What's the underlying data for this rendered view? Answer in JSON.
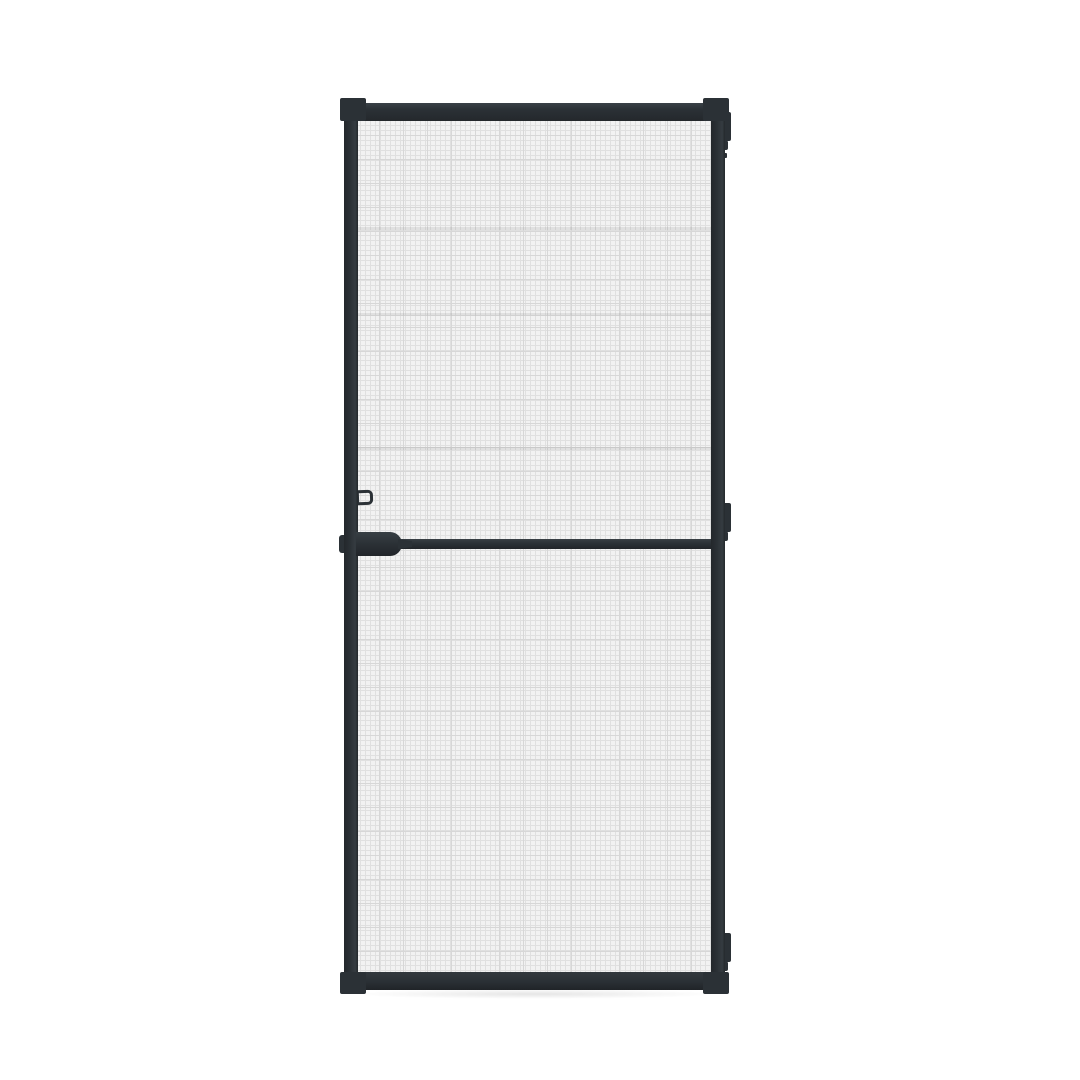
{
  "scene": {
    "background_color": "#ffffff",
    "subject": "Insect screen door product photo, dark frame with grey fibreglass mesh"
  },
  "door": {
    "frame_color": "#2b3136",
    "frame_highlight": "#3a4147",
    "mesh_base_color": "#f2f2f2",
    "mesh_grid_color": "#e0e0e0",
    "mesh_grid_strong_color": "#d7d7d7",
    "panels": {
      "count": 2,
      "divider": "horizontal crossbar"
    },
    "hinges": {
      "count": 3,
      "side": "right"
    },
    "handle": {
      "side": "left",
      "type": "crossbar grip bulge"
    },
    "latch": {
      "side": "left",
      "type": "keeper loop"
    }
  }
}
